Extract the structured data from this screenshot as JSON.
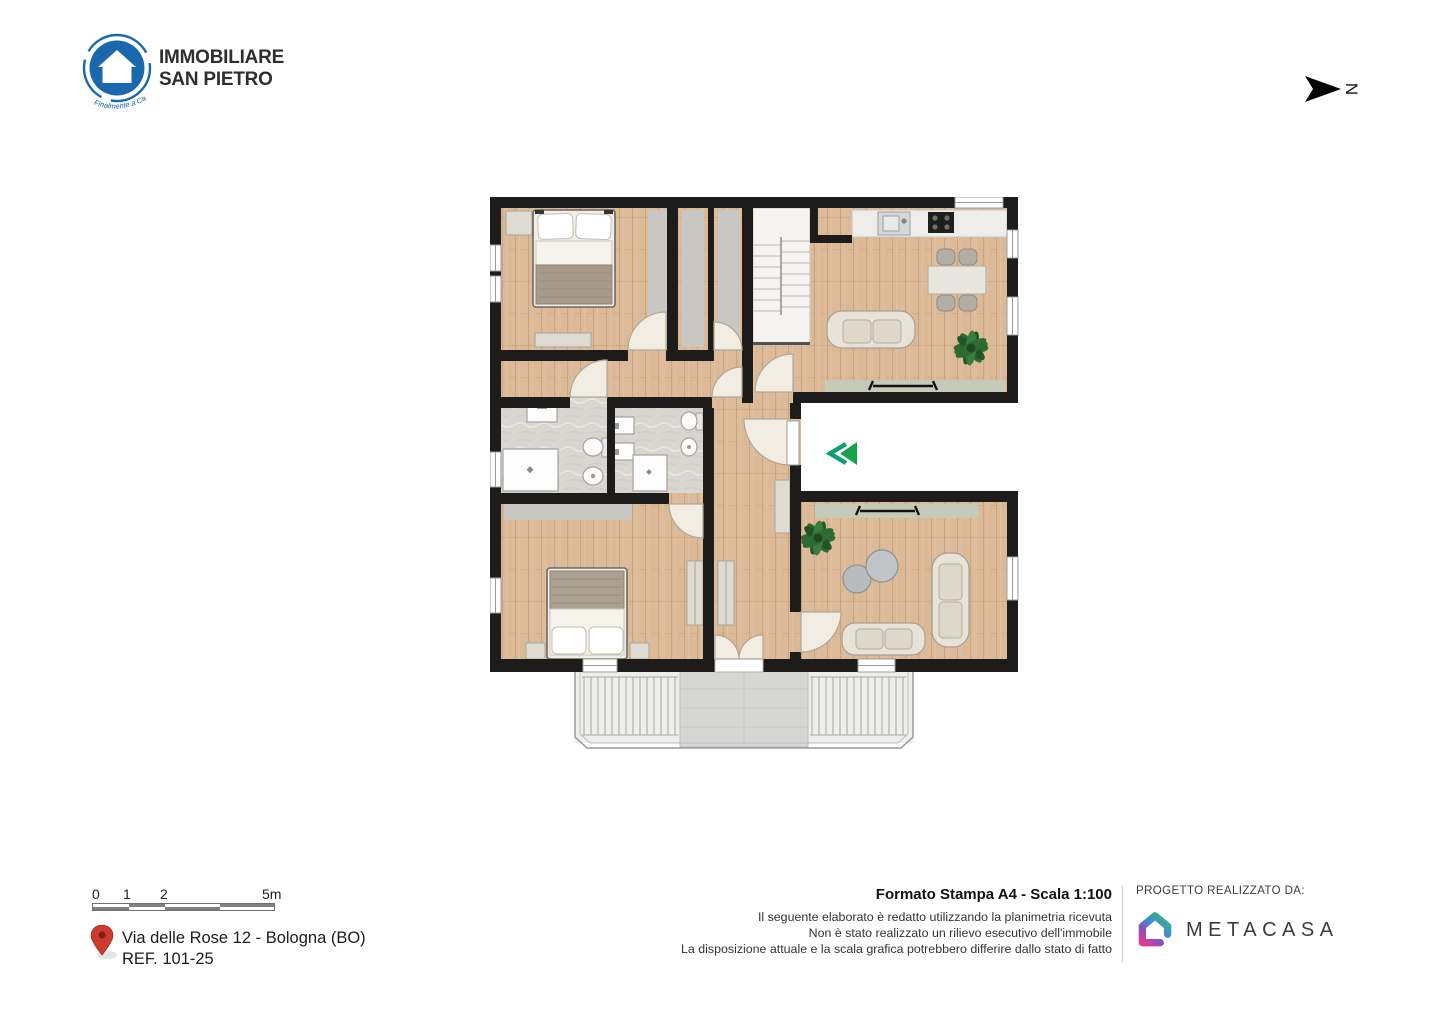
{
  "theme": {
    "brand_blue": "#1a67ad",
    "text_dark": "#2f2e2c",
    "wall": "#1d1c1a",
    "wood": "#dcba97",
    "tile": "#d9d5d1",
    "rug": "#c9c7c4",
    "radiator": "#c6cab8",
    "furniture_cream": "#e8e3d8",
    "fixture_white": "#fdfdfd",
    "accent_green": "#16a34a",
    "accent_teal": "#0d9f6f",
    "pin_red": "#cf3a2e",
    "stone": "#d6d6d4"
  },
  "logo": {
    "line1": "IMMOBILIARE",
    "line2": "SAN PIETRO",
    "tagline": "Finalmente a Casa"
  },
  "compass": {
    "label": "N"
  },
  "plan": {
    "entrance_marker": "double-chevron-left",
    "rooms": [
      "bedroom-1",
      "closet",
      "living-kitchen",
      "hall",
      "bathroom-1",
      "bathroom-2",
      "corridor",
      "bedroom-2",
      "living-room",
      "balcony"
    ]
  },
  "scale_bar": {
    "labels": [
      "0",
      "1",
      "2",
      "5m"
    ]
  },
  "address": {
    "line1": "Via delle Rose 12 - Bologna (BO)",
    "line2": "REF. 101-25"
  },
  "print_info": {
    "title": "Formato Stampa A4 - Scala 1:100",
    "disclaimer": [
      "Il seguente elaborato è redatto utilizzando la planimetria ricevuta",
      "Non è stato realizzato un rilievo esecutivo dell'immobile",
      "La disposizione attuale e la scala grafica potrebbero differire dallo stato di fatto"
    ]
  },
  "credits": {
    "label": "PROGETTO REALIZZATO DA:",
    "brand": "METACASA"
  }
}
